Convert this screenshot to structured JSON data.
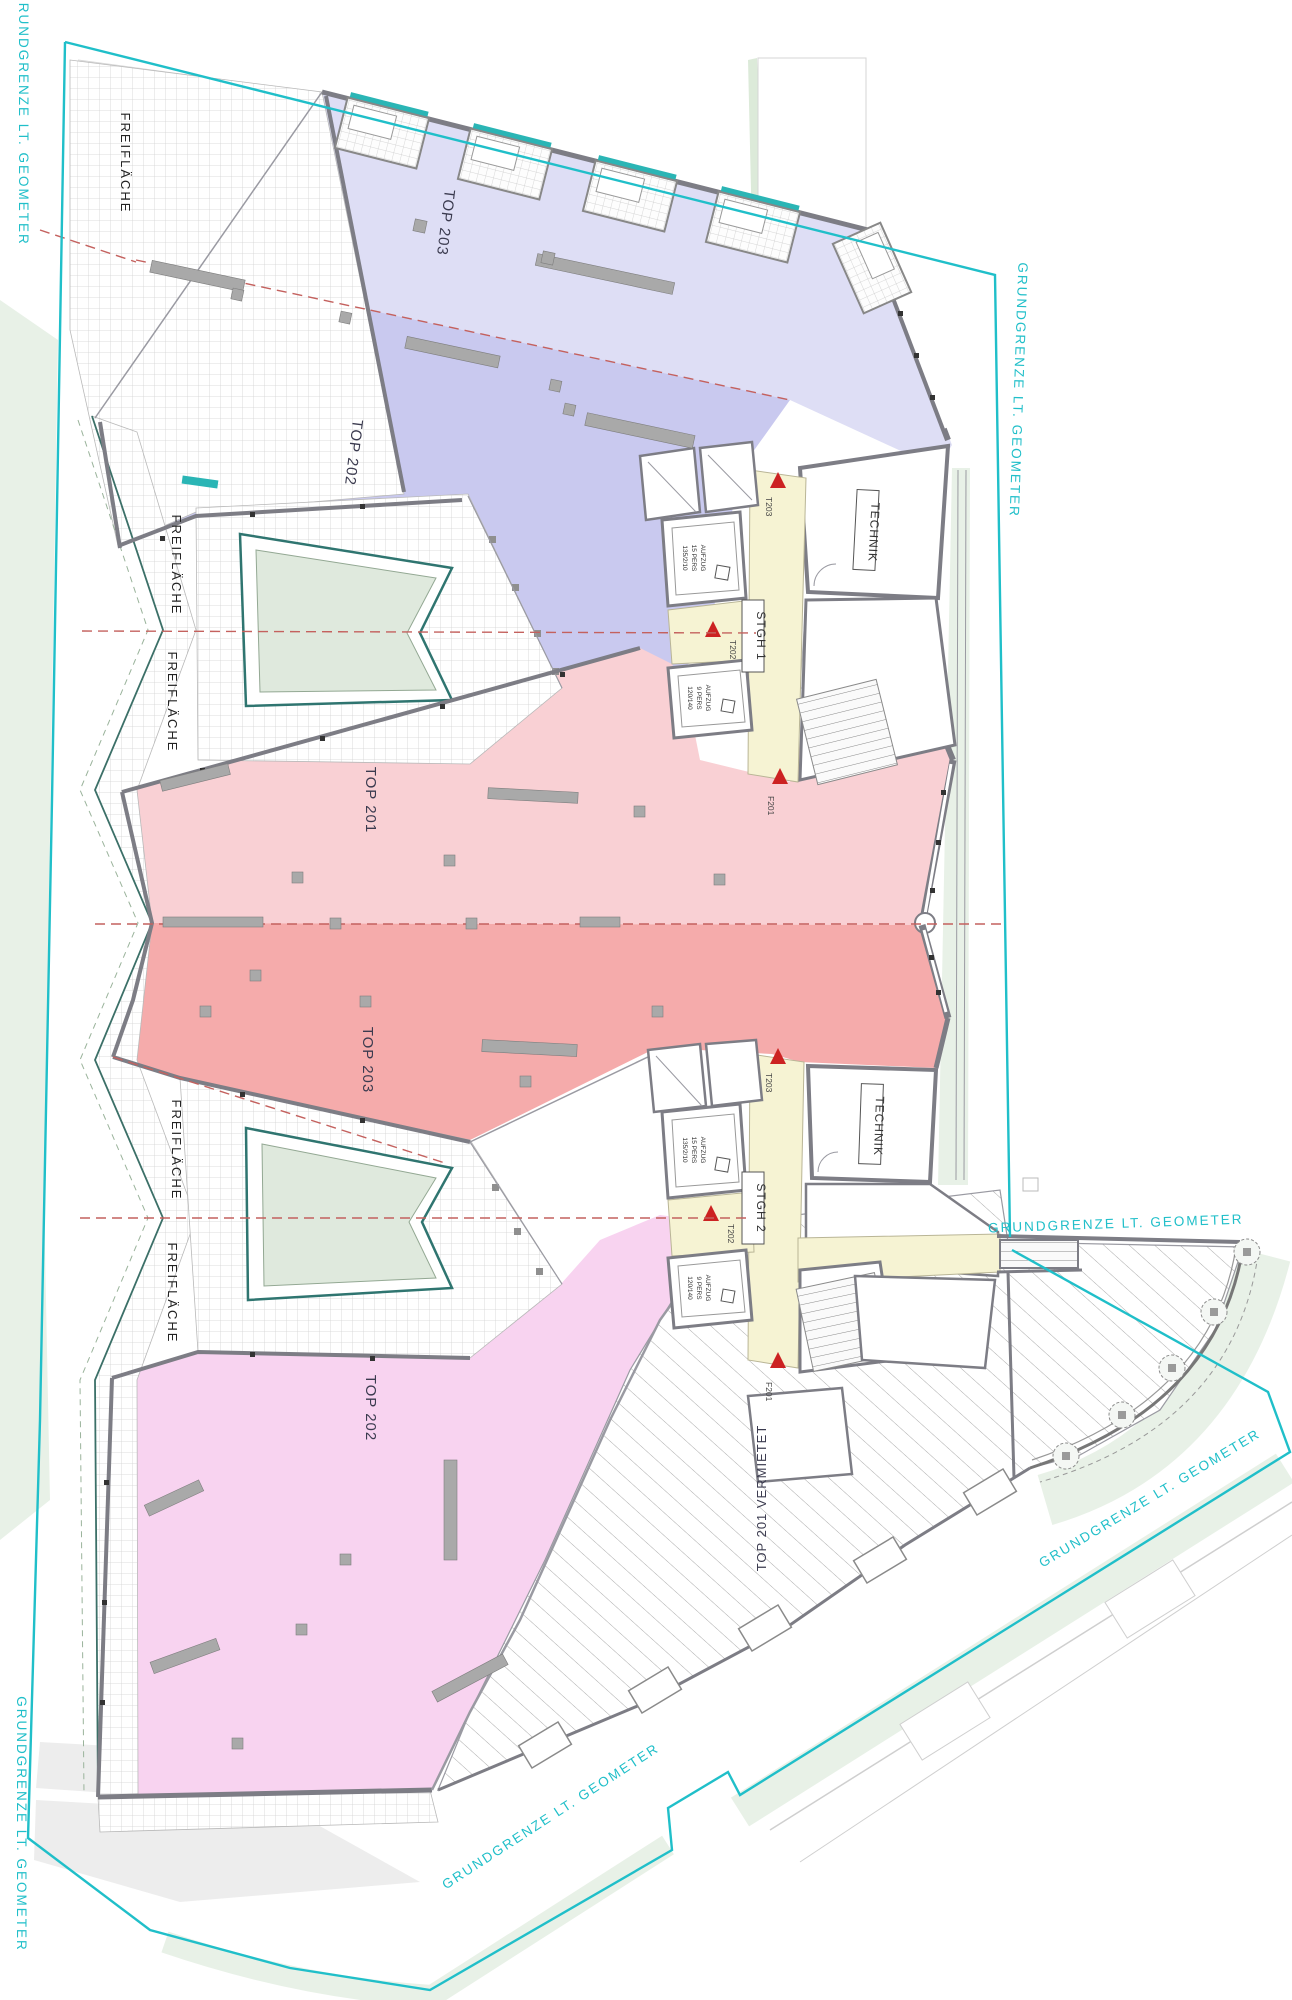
{
  "plan": {
    "colors": {
      "boundary": "#20bfc9",
      "z1": "#dedef5",
      "z2": "#c9c9ef",
      "z3": "#f9d0d4",
      "z4": "#f5abab",
      "z5": "#f8d3f0",
      "corridor": "#f6f3d3",
      "pool": "#dfe9dd",
      "pooledge": "#2f7570",
      "wall": "#7d7d85",
      "axisred": "#c4615e",
      "doorred": "#cc2222",
      "green": "#e8f1e7",
      "labeldark": "#3b3b4f"
    },
    "zones": [
      {
        "id": "top-203-north",
        "label": "TOP 203"
      },
      {
        "id": "top-202-north",
        "label": "TOP 202"
      },
      {
        "id": "top-201-north",
        "label": "TOP 201"
      },
      {
        "id": "top-203-south",
        "label": "TOP 203"
      },
      {
        "id": "top-202-south",
        "label": "TOP 202"
      },
      {
        "id": "top-201-south",
        "label": "TOP 201 VERMIETET"
      }
    ],
    "open_space_label": "FREIFLÄCHE",
    "boundary_label": "GRUNDGRENZE LT. GEOMETER",
    "stairwell_1": "STGH 1",
    "stairwell_2": "STGH 2",
    "technik_label": "TECHNIK",
    "elevator_large": {
      "line1": "AUFZUG",
      "line2": "15 PERS",
      "line3": "135/2/10"
    },
    "elevator_small": {
      "line1": "AUFZUG",
      "line2": "9 PERS",
      "line3": "120/140"
    },
    "doors": {
      "top": "T203",
      "mid": "T202",
      "bottom": "F201"
    }
  }
}
